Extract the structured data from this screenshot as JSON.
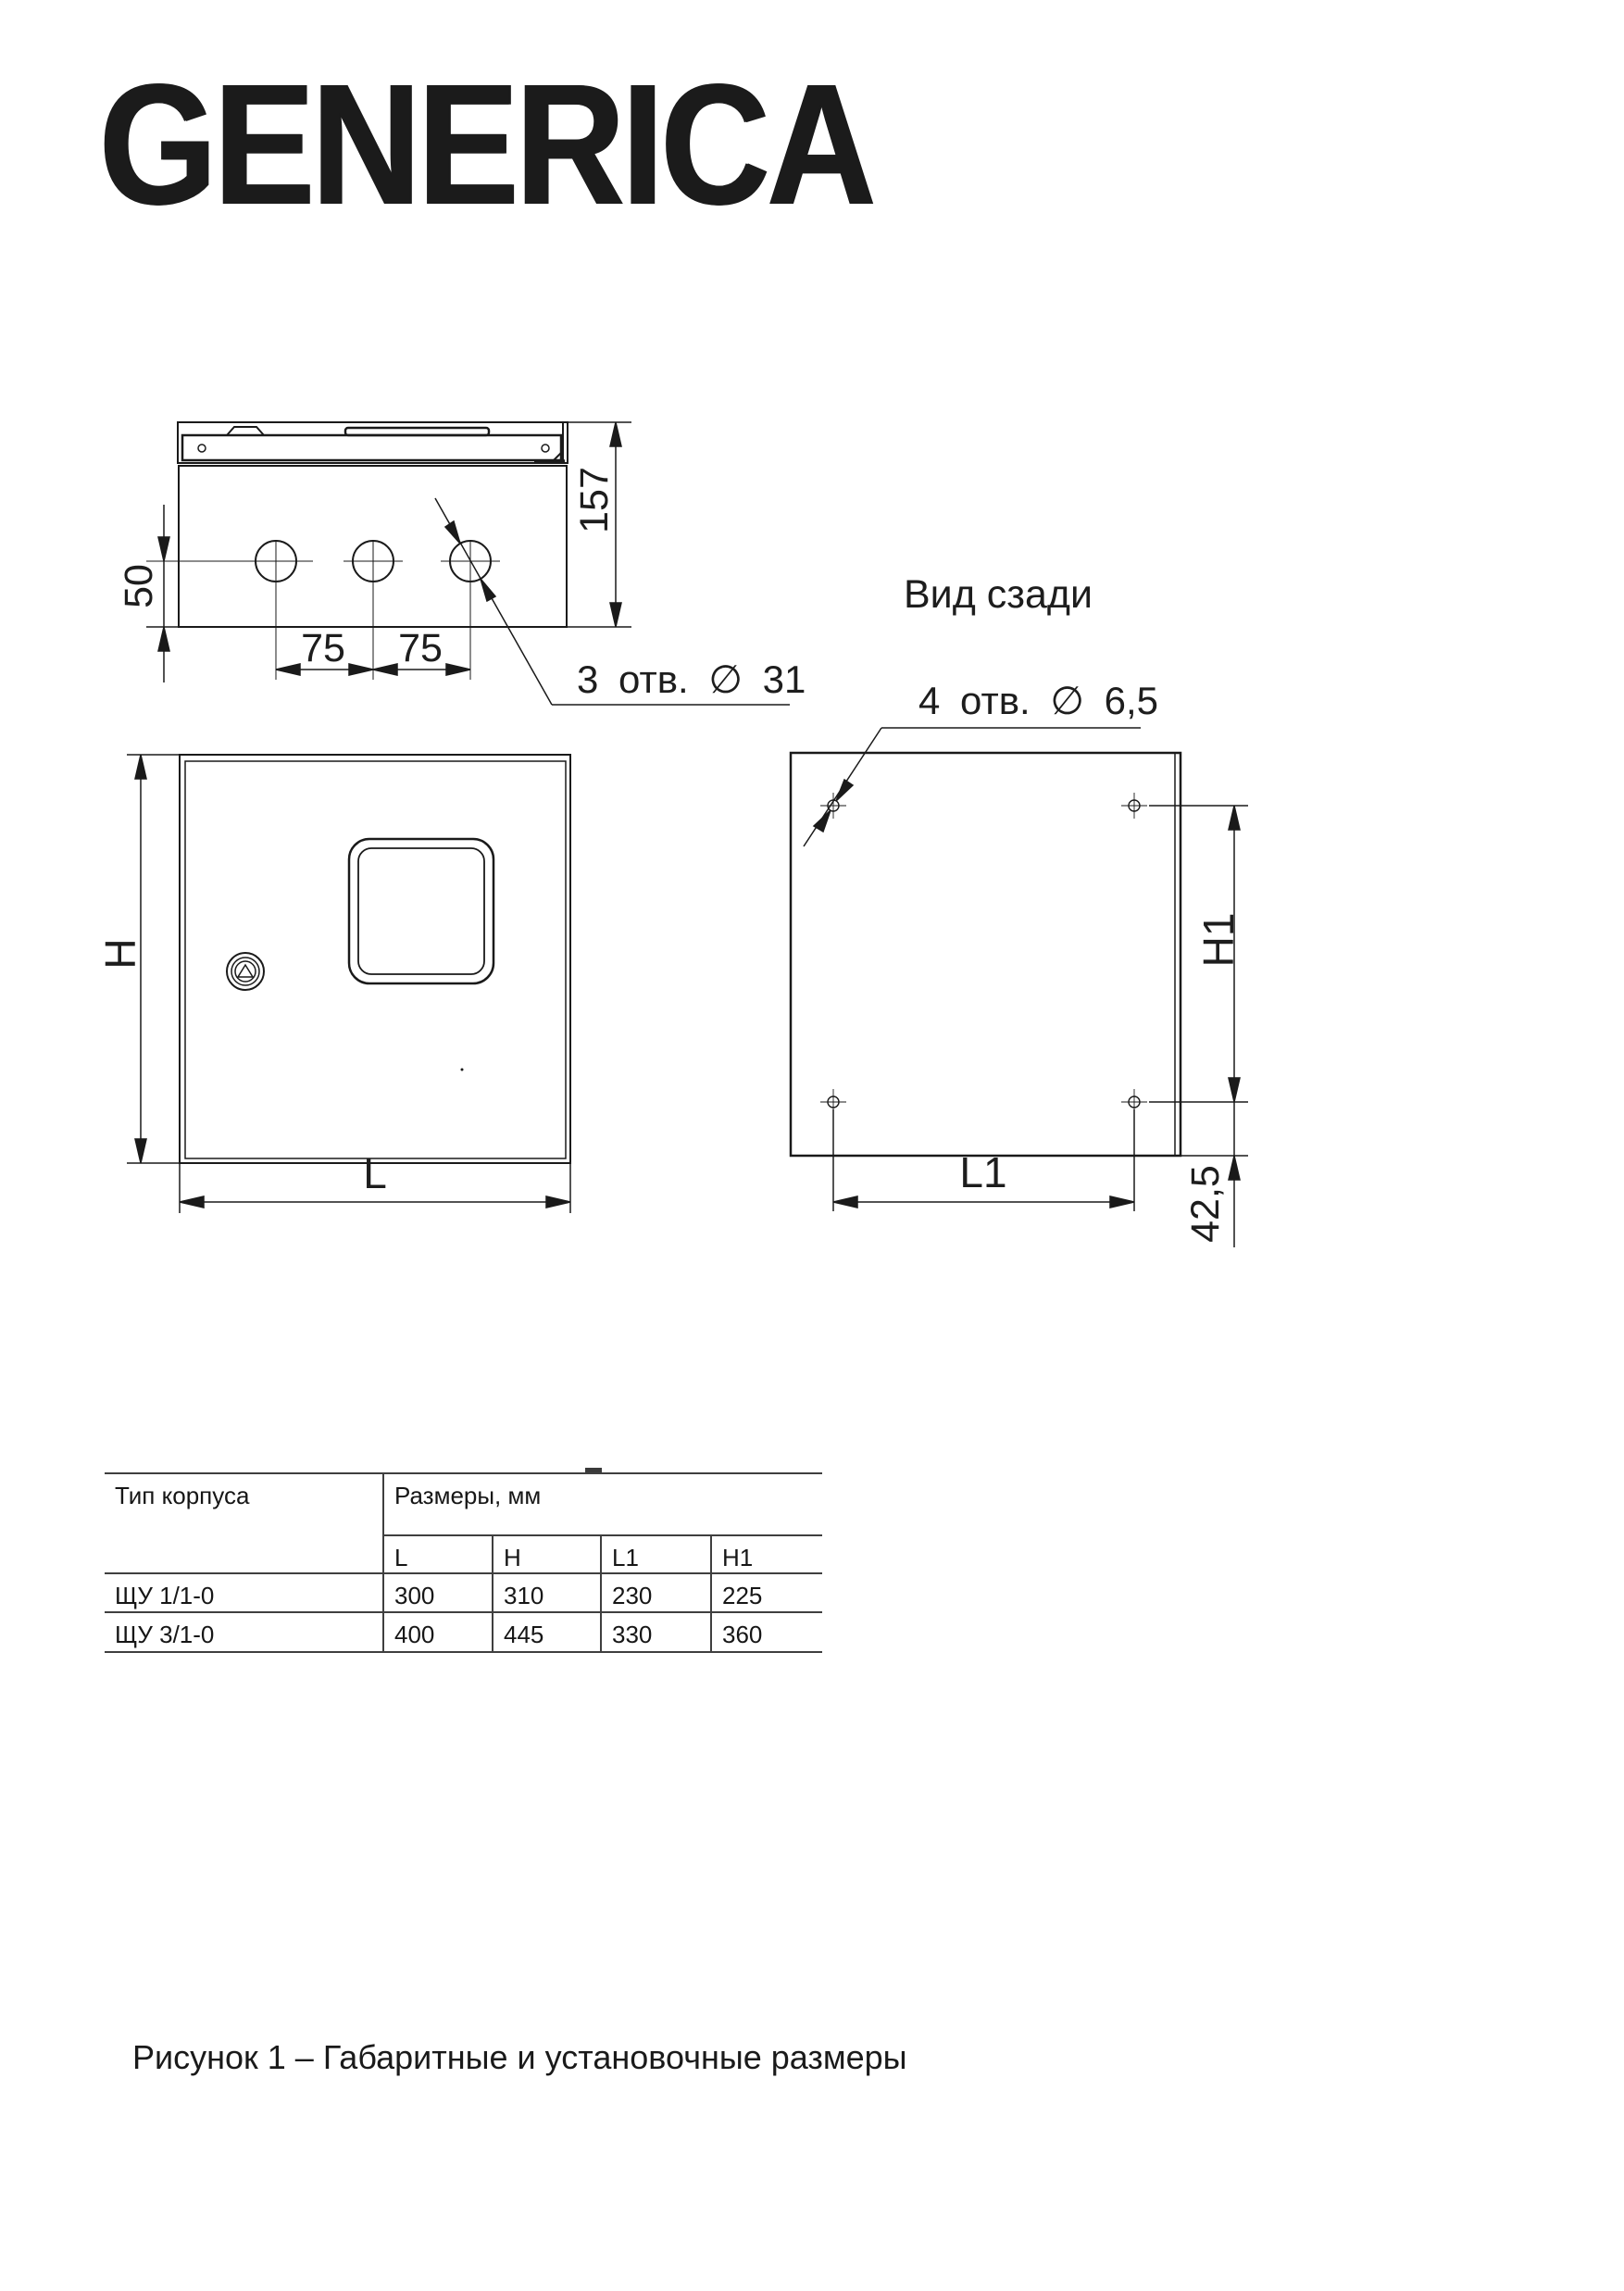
{
  "brand": {
    "logo_text": "GENERICA"
  },
  "drawing": {
    "top_view": {
      "dim_depth": "157",
      "dim_hole_offset": "50",
      "dim_hole_spacing_1": "75",
      "dim_hole_spacing_2": "75",
      "holes_note": "3 отв. ∅ 31"
    },
    "front_view": {
      "dim_height": "H",
      "dim_width": "L"
    },
    "rear_view": {
      "title": "Вид сзади",
      "holes_note": "4 отв. ∅ 6,5",
      "dim_height": "H1",
      "dim_width": "L1",
      "dim_bottom_offset": "42,5"
    }
  },
  "table": {
    "col_type_header": "Тип корпуса",
    "col_group_header": "Размеры, мм",
    "sub_headers": [
      "L",
      "H",
      "L1",
      "H1"
    ],
    "rows": [
      {
        "type": "ЩУ 1/1-0",
        "values": [
          "300",
          "310",
          "230",
          "225"
        ]
      },
      {
        "type": "ЩУ 3/1-0",
        "values": [
          "400",
          "445",
          "330",
          "360"
        ]
      }
    ]
  },
  "caption": "Рисунок 1 – Габаритные и установочные размеры",
  "colors": {
    "line": "#1a1a1a",
    "table_line": "#3f3f3f",
    "text": "#1d1d1d",
    "background": "#ffffff"
  }
}
